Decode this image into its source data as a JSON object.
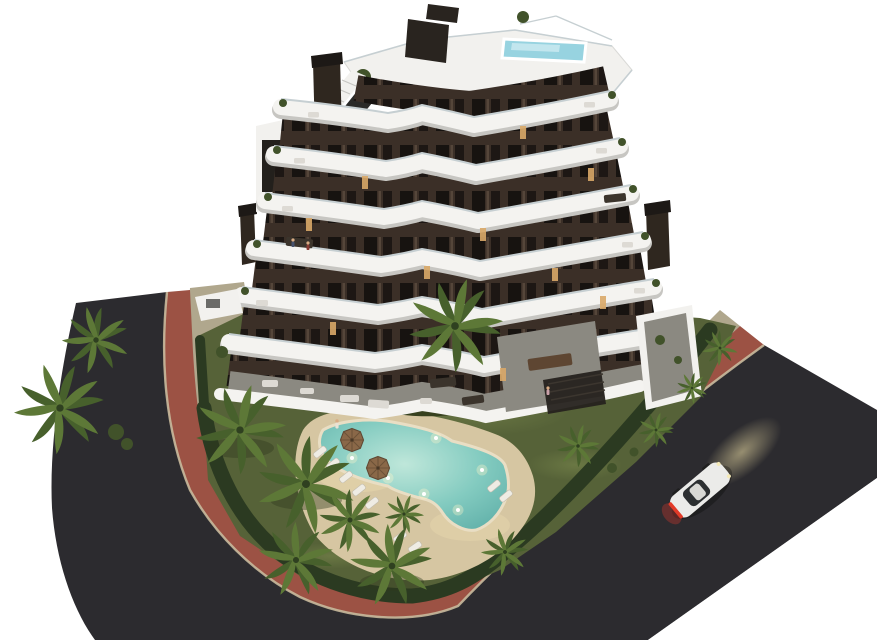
{
  "scene": {
    "title": "Aerial dusk rendering of a modern apartment complex",
    "building": "Six-storey stepped block, dark bronze facade, curved white balcony bands, rooftop terrace with plunge pool and stair access",
    "garden": "Olive lawn, clipped hedge perimeter, planting island, palm trees",
    "pool": "Free-form lagoon pool with underwater lights, sand-colored deck, sun loungers and parasols",
    "streets": "Dark asphalt corner road wrapping the plot with a terracotta footpath and pale curb",
    "vehicle": "White coupe with red taillights driving up the right-hand road, headlights glowing"
  },
  "colors": {
    "bg": "#ffffff",
    "asphalt": "#2c2b2f",
    "path-red": "#9c5244",
    "curb": "#c8b99c",
    "walkway": "#b0a78d",
    "lawn": "#566238",
    "lawn-light": "#75834a",
    "hedge": "#2b3a21",
    "bush": "#41522a",
    "deck": "#d6c6a2",
    "deck-lit": "#ecd9ae",
    "island": "#37411f",
    "pool-light": "#bfe7da",
    "pool-mid": "#83cbc0",
    "pool-deep": "#5fafa8",
    "pool-rim": "#e9dec4",
    "wall": "#3b2f27",
    "window": "#171310",
    "window-lit": "#d9a968",
    "window-frame": "#55463a",
    "band": "#f4f3f0",
    "band-shadow": "#c7c6c2",
    "glass-rail": "#c6cfd2",
    "roof": "#f2f1ee",
    "jacuzzi": "#97d3e0",
    "jacuzzi-light": "#c2e6ee",
    "screen": "#29241f",
    "chimney": "#2f271f",
    "frond": "#5d7837",
    "frond-dark": "#47602c",
    "trunk": "#6f5b42",
    "patio": "#8b8981",
    "furniture-light": "#dddad4",
    "furniture-dark": "#3b342c",
    "skin": "#d8ab84",
    "car-body": "#ebebe9",
    "car-glass": "#2c2f31",
    "taillight": "#e23a28",
    "glow": "#eedfa6"
  }
}
